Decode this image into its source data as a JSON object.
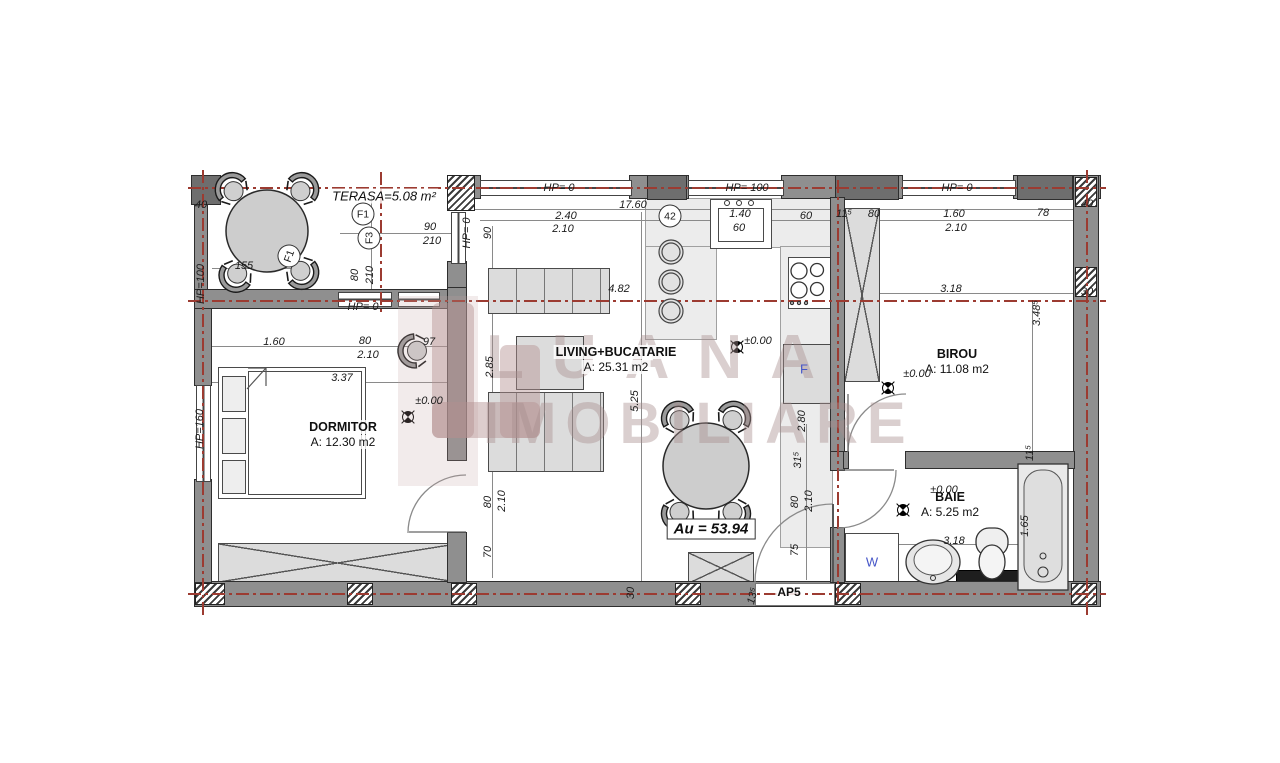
{
  "watermark": {
    "line1": "LUANA",
    "line2": "IMOBILIARE"
  },
  "rooms": {
    "terasa": {
      "name": "TERASA=5.08 m²"
    },
    "dormitor": {
      "name": "DORMITOR",
      "area": "A: 12.30 m2"
    },
    "living": {
      "name": "LIVING+BUCATARIE",
      "area": "A: 25.31 m2"
    },
    "birou": {
      "name": "BIROU",
      "area": "A: 11.08 m2"
    },
    "baie": {
      "name": "BAIE",
      "area": "A: 5.25 m2"
    }
  },
  "labels": {
    "total_area": "Au = 53.94",
    "apartment": "AP5",
    "washer": "W",
    "fridge": "F"
  },
  "colors": {
    "axis_red": "#9c3b31",
    "wall_gray": "#8f8f8f",
    "accent_blue": "#4656c8",
    "watermark_pink": "rgba(167,141,141,0.42)"
  },
  "dims": [
    {
      "t": "40",
      "x": 201,
      "y": 205
    },
    {
      "t": "90",
      "x": 430,
      "y": 227
    },
    {
      "t": "210",
      "x": 432,
      "y": 241
    },
    {
      "t": "155",
      "x": 244,
      "y": 266
    },
    {
      "t": "80",
      "x": 355,
      "y": 275,
      "r": -90
    },
    {
      "t": "210",
      "x": 370,
      "y": 275,
      "r": -90
    },
    {
      "t": "HP=100",
      "x": 201,
      "y": 284,
      "r": -90
    },
    {
      "t": "HP= 0",
      "x": 363,
      "y": 307
    },
    {
      "t": "HP= 0",
      "x": 559,
      "y": 188
    },
    {
      "t": "HP= 100",
      "x": 747,
      "y": 188
    },
    {
      "t": "HP= 0",
      "x": 957,
      "y": 188
    },
    {
      "t": "HP= 0",
      "x": 467,
      "y": 233,
      "r": -90
    },
    {
      "t": "17.60",
      "x": 633,
      "y": 205
    },
    {
      "t": "2.40",
      "x": 566,
      "y": 216
    },
    {
      "t": "2.10",
      "x": 563,
      "y": 229
    },
    {
      "t": "42",
      "x": 670,
      "y": 216,
      "c": 1
    },
    {
      "t": "F1",
      "x": 363,
      "y": 214,
      "c": 1
    },
    {
      "t": "F3",
      "x": 369,
      "y": 238,
      "r": -90,
      "c": 1
    },
    {
      "t": "F1",
      "x": 289,
      "y": 256,
      "r": -70,
      "c": 1
    },
    {
      "t": "1.40",
      "x": 740,
      "y": 214
    },
    {
      "t": "60",
      "x": 739,
      "y": 228
    },
    {
      "t": "60",
      "x": 806,
      "y": 216
    },
    {
      "t": "11⁵",
      "x": 844,
      "y": 214
    },
    {
      "t": "80",
      "x": 874,
      "y": 214
    },
    {
      "t": "1.60",
      "x": 954,
      "y": 214
    },
    {
      "t": "2.10",
      "x": 956,
      "y": 228
    },
    {
      "t": "78",
      "x": 1043,
      "y": 213
    },
    {
      "t": "40",
      "x": 1087,
      "y": 204
    },
    {
      "t": "90",
      "x": 488,
      "y": 233,
      "r": -90
    },
    {
      "t": "4.82",
      "x": 619,
      "y": 289
    },
    {
      "t": "3.18",
      "x": 951,
      "y": 289
    },
    {
      "t": "30",
      "x": 1087,
      "y": 292
    },
    {
      "t": "3.48⁵",
      "x": 1037,
      "y": 313,
      "r": -90
    },
    {
      "t": "2.85",
      "x": 490,
      "y": 367,
      "r": -90
    },
    {
      "t": "1.60",
      "x": 274,
      "y": 342
    },
    {
      "t": "80",
      "x": 365,
      "y": 341
    },
    {
      "t": "2.10",
      "x": 368,
      "y": 355
    },
    {
      "t": "97",
      "x": 429,
      "y": 342
    },
    {
      "t": "3.37",
      "x": 342,
      "y": 378
    },
    {
      "t": "±0.00",
      "x": 429,
      "y": 401
    },
    {
      "t": "HP=160",
      "x": 200,
      "y": 429,
      "r": -90
    },
    {
      "t": "5.25",
      "x": 635,
      "y": 401,
      "r": -90
    },
    {
      "t": "±0.00",
      "x": 758,
      "y": 341
    },
    {
      "t": "±0.00",
      "x": 917,
      "y": 374
    },
    {
      "t": "2.80",
      "x": 802,
      "y": 421,
      "r": -90
    },
    {
      "t": "31⁵",
      "x": 798,
      "y": 460,
      "r": -90
    },
    {
      "t": "80",
      "x": 795,
      "y": 502,
      "r": -90
    },
    {
      "t": "2.10",
      "x": 809,
      "y": 501,
      "r": -90
    },
    {
      "t": "75",
      "x": 795,
      "y": 550,
      "r": -90
    },
    {
      "t": "80",
      "x": 488,
      "y": 502,
      "r": -90
    },
    {
      "t": "2.10",
      "x": 502,
      "y": 501,
      "r": -90
    },
    {
      "t": "70",
      "x": 488,
      "y": 552,
      "r": -90
    },
    {
      "t": "30",
      "x": 631,
      "y": 593,
      "r": -90
    },
    {
      "t": "13⁵",
      "x": 753,
      "y": 596,
      "r": -75
    },
    {
      "t": "±0.00",
      "x": 944,
      "y": 490
    },
    {
      "t": "1.65",
      "x": 1025,
      "y": 526,
      "r": -90
    },
    {
      "t": "11⁵",
      "x": 1030,
      "y": 453,
      "r": -90
    },
    {
      "t": "3.18",
      "x": 954,
      "y": 541
    }
  ]
}
